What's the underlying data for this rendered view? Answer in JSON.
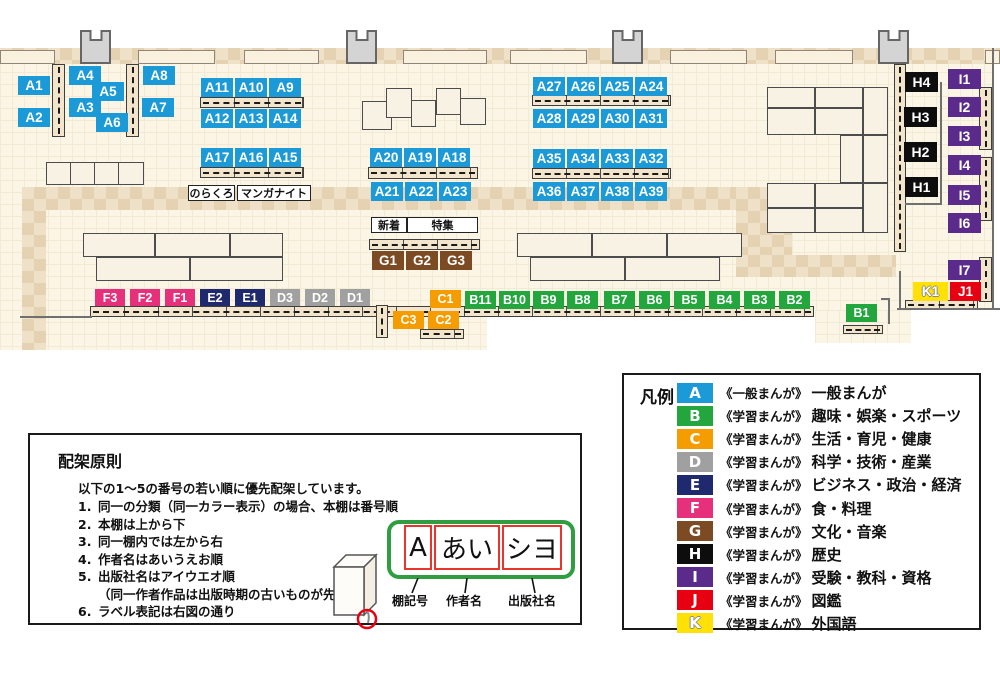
{
  "colors": {
    "A": "#1b9ad7",
    "B": "#22a63d",
    "C": "#f49c00",
    "D": "#a0a0a0",
    "E": "#1f2a6e",
    "F": "#e7307c",
    "G": "#7c4a23",
    "H": "#0d0d0d",
    "I": "#5b2b8c",
    "J": "#e60012",
    "K": "#ffe105"
  },
  "map": {
    "shelf_labels": [
      {
        "t": "A1",
        "x": 18,
        "y": 76
      },
      {
        "t": "A2",
        "x": 18,
        "y": 108
      },
      {
        "t": "A4",
        "x": 69,
        "y": 66
      },
      {
        "t": "A5",
        "x": 92,
        "y": 82
      },
      {
        "t": "A3",
        "x": 69,
        "y": 98
      },
      {
        "t": "A6",
        "x": 96,
        "y": 113
      },
      {
        "t": "A8",
        "x": 143,
        "y": 66
      },
      {
        "t": "A7",
        "x": 142,
        "y": 98
      },
      {
        "t": "A11",
        "x": 201,
        "y": 78
      },
      {
        "t": "A10",
        "x": 235,
        "y": 78
      },
      {
        "t": "A9",
        "x": 269,
        "y": 78
      },
      {
        "t": "A12",
        "x": 201,
        "y": 109
      },
      {
        "t": "A13",
        "x": 235,
        "y": 109
      },
      {
        "t": "A14",
        "x": 269,
        "y": 109
      },
      {
        "t": "A17",
        "x": 201,
        "y": 148
      },
      {
        "t": "A16",
        "x": 235,
        "y": 148
      },
      {
        "t": "A15",
        "x": 269,
        "y": 148
      },
      {
        "t": "A20",
        "x": 370,
        "y": 148
      },
      {
        "t": "A19",
        "x": 404,
        "y": 148
      },
      {
        "t": "A18",
        "x": 438,
        "y": 148
      },
      {
        "t": "A21",
        "x": 371,
        "y": 182
      },
      {
        "t": "A22",
        "x": 405,
        "y": 182
      },
      {
        "t": "A23",
        "x": 439,
        "y": 182
      },
      {
        "t": "A27",
        "x": 533,
        "y": 77
      },
      {
        "t": "A26",
        "x": 567,
        "y": 77
      },
      {
        "t": "A25",
        "x": 601,
        "y": 77
      },
      {
        "t": "A24",
        "x": 635,
        "y": 77
      },
      {
        "t": "A28",
        "x": 533,
        "y": 109
      },
      {
        "t": "A29",
        "x": 567,
        "y": 109
      },
      {
        "t": "A30",
        "x": 601,
        "y": 109
      },
      {
        "t": "A31",
        "x": 635,
        "y": 109
      },
      {
        "t": "A35",
        "x": 533,
        "y": 149
      },
      {
        "t": "A34",
        "x": 567,
        "y": 149
      },
      {
        "t": "A33",
        "x": 601,
        "y": 149
      },
      {
        "t": "A32",
        "x": 635,
        "y": 149
      },
      {
        "t": "A36",
        "x": 533,
        "y": 182
      },
      {
        "t": "A37",
        "x": 567,
        "y": 182
      },
      {
        "t": "A38",
        "x": 601,
        "y": 182
      },
      {
        "t": "A39",
        "x": 635,
        "y": 182
      },
      {
        "t": "G1",
        "x": 372,
        "y": 251
      },
      {
        "t": "G2",
        "x": 406,
        "y": 251
      },
      {
        "t": "G3",
        "x": 440,
        "y": 251
      },
      {
        "t": "F3",
        "x": 95,
        "y": 289
      },
      {
        "t": "F2",
        "x": 130,
        "y": 289
      },
      {
        "t": "F1",
        "x": 165,
        "y": 289
      },
      {
        "t": "E2",
        "x": 200,
        "y": 289
      },
      {
        "t": "E1",
        "x": 235,
        "y": 289
      },
      {
        "t": "D3",
        "x": 270,
        "y": 289
      },
      {
        "t": "D2",
        "x": 305,
        "y": 289
      },
      {
        "t": "D1",
        "x": 340,
        "y": 289
      },
      {
        "t": "C1",
        "x": 430,
        "y": 290
      },
      {
        "t": "C3",
        "x": 393,
        "y": 311
      },
      {
        "t": "C2",
        "x": 428,
        "y": 311
      },
      {
        "t": "B11",
        "x": 465,
        "y": 291
      },
      {
        "t": "B10",
        "x": 499,
        "y": 291
      },
      {
        "t": "B9",
        "x": 533,
        "y": 291
      },
      {
        "t": "B8",
        "x": 567,
        "y": 291
      },
      {
        "t": "B7",
        "x": 604,
        "y": 291
      },
      {
        "t": "B6",
        "x": 639,
        "y": 291
      },
      {
        "t": "B5",
        "x": 674,
        "y": 291
      },
      {
        "t": "B4",
        "x": 709,
        "y": 291
      },
      {
        "t": "B3",
        "x": 744,
        "y": 291
      },
      {
        "t": "B2",
        "x": 779,
        "y": 291
      },
      {
        "t": "B1",
        "x": 846,
        "y": 304
      },
      {
        "t": "H4",
        "x": 905,
        "y": 72
      },
      {
        "t": "H3",
        "x": 904,
        "y": 107
      },
      {
        "t": "H2",
        "x": 904,
        "y": 142
      },
      {
        "t": "H1",
        "x": 905,
        "y": 177
      },
      {
        "t": "I1",
        "x": 948,
        "y": 69
      },
      {
        "t": "I2",
        "x": 948,
        "y": 97
      },
      {
        "t": "I3",
        "x": 948,
        "y": 126
      },
      {
        "t": "I4",
        "x": 948,
        "y": 155
      },
      {
        "t": "I5",
        "x": 948,
        "y": 185
      },
      {
        "t": "I6",
        "x": 948,
        "y": 213
      },
      {
        "t": "I7",
        "x": 948,
        "y": 260
      },
      {
        "t": "K1",
        "x": 913,
        "y": 282
      },
      {
        "t": "J1",
        "x": 950,
        "y": 282
      }
    ],
    "annotations": [
      {
        "t": "のらくろ",
        "x": 188,
        "y": 185,
        "w": 47,
        "h": 16
      },
      {
        "t": "マンガナイト",
        "x": 237,
        "y": 185,
        "w": 74,
        "h": 16
      },
      {
        "t": "新着",
        "x": 371,
        "y": 217,
        "w": 36,
        "h": 16
      },
      {
        "t": "特集",
        "x": 407,
        "y": 217,
        "w": 71,
        "h": 16
      }
    ]
  },
  "legend": {
    "title": "凡例",
    "items": [
      {
        "code": "A",
        "series": "《一般まんが》",
        "category": "一般まんが"
      },
      {
        "code": "B",
        "series": "《学習まんが》",
        "category": "趣味・娯楽・スポーツ"
      },
      {
        "code": "C",
        "series": "《学習まんが》",
        "category": "生活・育児・健康"
      },
      {
        "code": "D",
        "series": "《学習まんが》",
        "category": "科学・技術・産業"
      },
      {
        "code": "E",
        "series": "《学習まんが》",
        "category": "ビジネス・政治・経済"
      },
      {
        "code": "F",
        "series": "《学習まんが》",
        "category": "食・料理"
      },
      {
        "code": "G",
        "series": "《学習まんが》",
        "category": "文化・音楽"
      },
      {
        "code": "H",
        "series": "《学習まんが》",
        "category": "歴史"
      },
      {
        "code": "I",
        "series": "《学習まんが》",
        "category": "受験・教科・資格"
      },
      {
        "code": "J",
        "series": "《学習まんが》",
        "category": "図鑑"
      },
      {
        "code": "K",
        "series": "《学習まんが》",
        "category": "外国語"
      }
    ]
  },
  "principles": {
    "title": "配架原則",
    "intro": "以下の1～5の番号の若い順に優先配架しています。",
    "items": [
      {
        "n": "1.",
        "t": "同一の分類（同一カラー表示）の場合、本棚は番号順"
      },
      {
        "n": "2.",
        "t": "本棚は上から下"
      },
      {
        "n": "3.",
        "t": "同一棚内では左から右"
      },
      {
        "n": "4.",
        "t": "作者名はあいうえお順"
      },
      {
        "n": "5.",
        "t": "出版社名はアイウエオ順"
      },
      {
        "n": "",
        "t": "（同一作者作品は出版時期の古いものが先）"
      },
      {
        "n": "6.",
        "t": "ラベル表記は右図の通り"
      }
    ],
    "diagram": {
      "boxes": [
        "A",
        "あい",
        "シヨ"
      ],
      "captions": [
        "棚記号",
        "作者名",
        "出版社名"
      ]
    }
  }
}
